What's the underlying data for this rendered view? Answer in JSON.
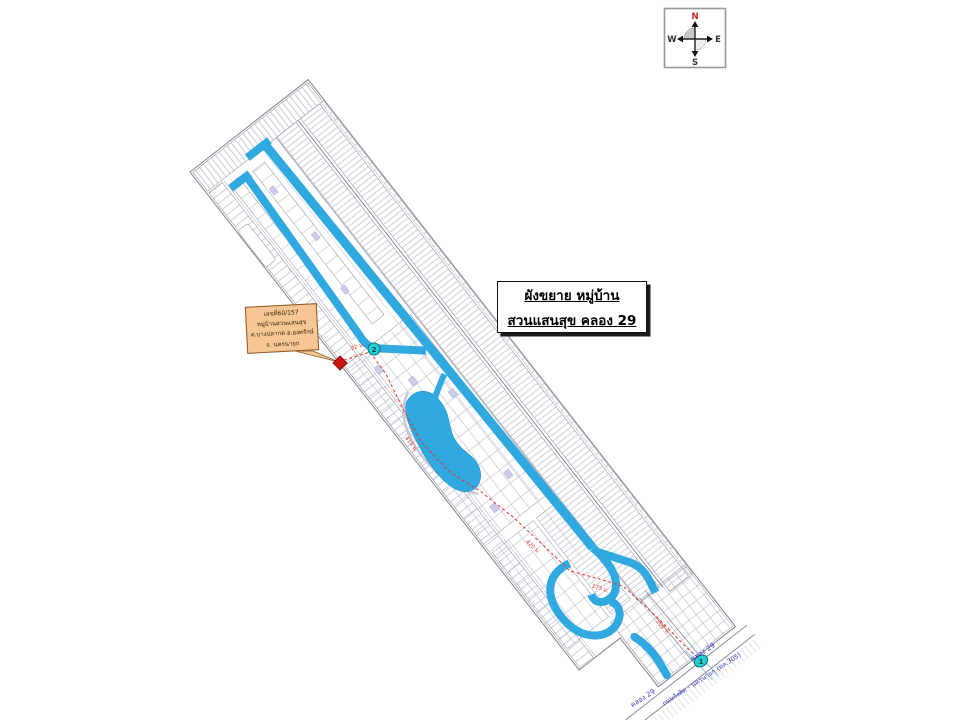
{
  "compass": {
    "n": "N",
    "e": "E",
    "s": "S",
    "w": "W"
  },
  "title_box": {
    "line1": "ผังขยาย หมู่บ้าน",
    "line2": "สวนแสนสุข คลอง 29"
  },
  "address_box": {
    "line1": "เลขที่60/157",
    "line2": "หมู่บ้านสวนแสนสุข",
    "line3": "ต.บางปลากด อ.องครักษ์",
    "line4": "จ. นครนายก"
  },
  "markers": {
    "entrance_no": "1",
    "house_no": "2"
  },
  "distances": {
    "d1": "32 ม.",
    "d2": "410 ม.",
    "d3": "420 ม.",
    "d4": "175 ม.",
    "d5": "200 ม."
  },
  "roads": {
    "khlong29_left": "คลอง 29",
    "khlong29_right": "คลอง 29",
    "highway": "ถนนรังสิต - นครนายก (ทล.305)"
  },
  "colors": {
    "canal_blue": "#2FA9E0",
    "marker_teal": "#25CFCF",
    "route_red": "#E8342A",
    "plot_line": "#A2A2B8",
    "callout_fill": "#F6C795",
    "callout_border": "#8C5A28"
  }
}
